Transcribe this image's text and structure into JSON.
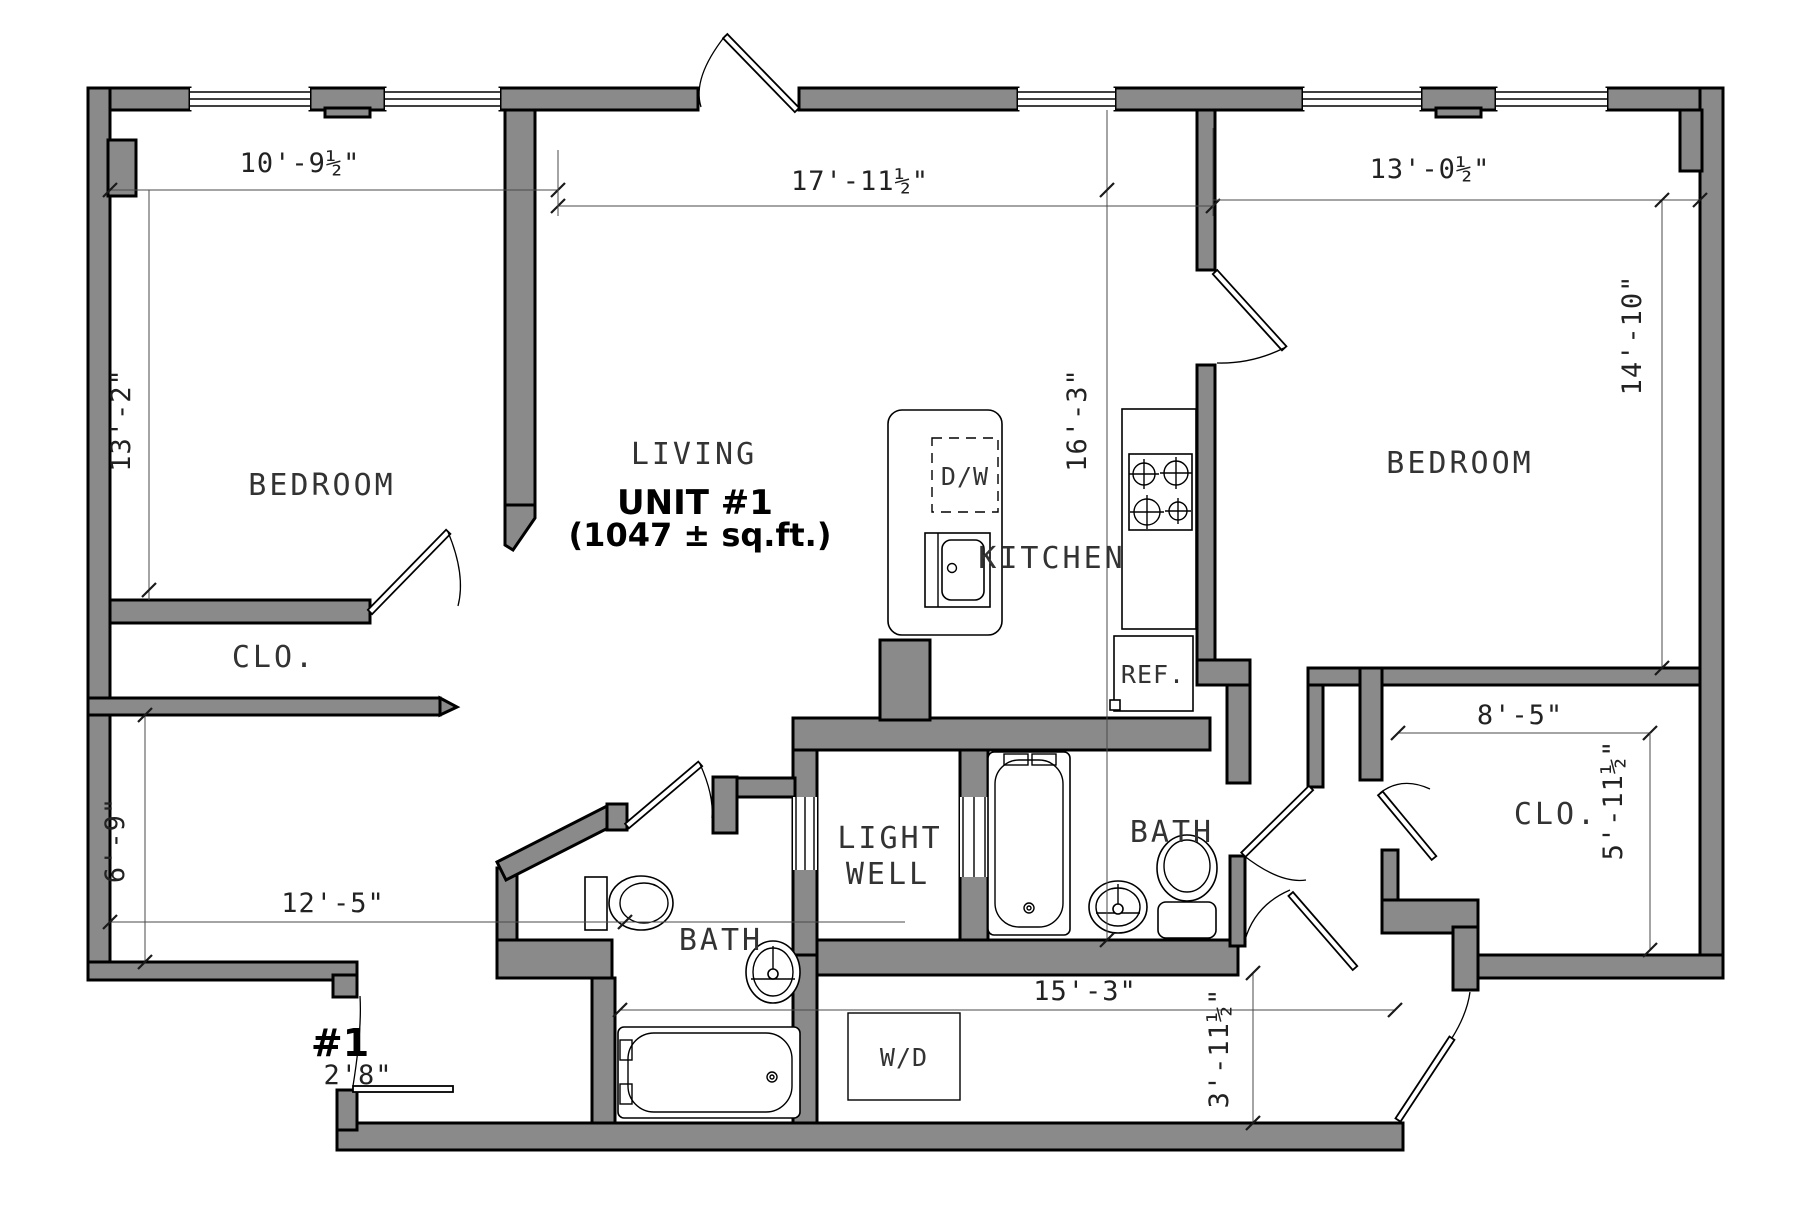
{
  "plan": {
    "unit": {
      "title": "UNIT #1",
      "area": "(1047 ± sq.ft.)"
    },
    "rooms": {
      "bedroom_left": "BEDROOM",
      "bedroom_right": "BEDROOM",
      "living": "LIVING",
      "kitchen": "KITCHEN",
      "closet_left": "CLO.",
      "closet_right": "CLO.",
      "bath_left": "BATH",
      "bath_right": "BATH",
      "light_well_line1": "LIGHT",
      "light_well_line2": "WELL"
    },
    "appliances": {
      "dishwasher": "D/W",
      "refrigerator": "REF.",
      "washer_dryer": "W/D"
    },
    "entry_door": {
      "number": "#1",
      "width": "2'8\""
    },
    "dimensions": {
      "top_left": "10'-9½\"",
      "top_middle": "17'-11½\"",
      "top_right": "13'-0½\"",
      "left_upper": "13'-2\"",
      "left_lower": "6'-9\"",
      "right_upper": "14'-10\"",
      "kitchen_depth": "16'-3\"",
      "bottom_left": "12'-5\"",
      "bottom_middle": "15'-3\"",
      "corridor_width": "3'-11½\"",
      "closet_right_width": "8'-5\"",
      "closet_right_depth": "5'-11½\""
    },
    "colors": {
      "wall_fill": "#8a8a8a",
      "line": "#000000"
    }
  }
}
